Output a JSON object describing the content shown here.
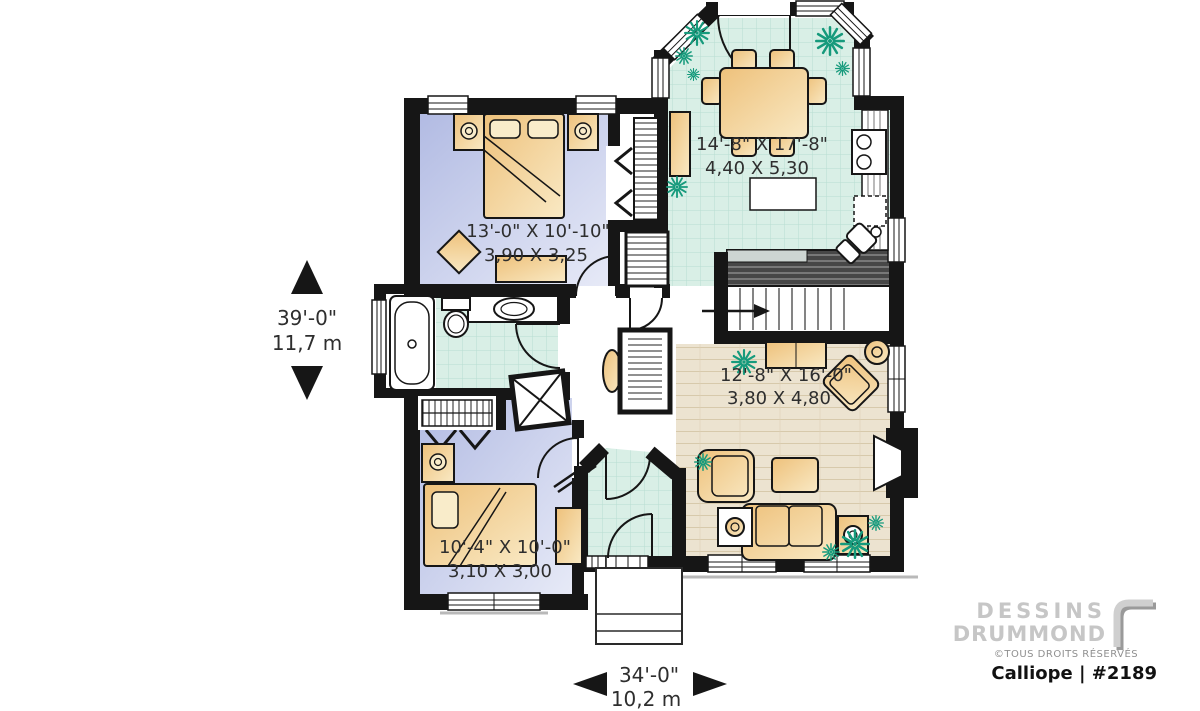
{
  "canvas": {
    "width": 1200,
    "height": 711,
    "background": "#ffffff"
  },
  "labels": {
    "dining": {
      "imperial": "14'-8\" X 17'-8\"",
      "metric": "4,40 X 5,30"
    },
    "master": {
      "imperial": "13'-0\" X 10'-10\"",
      "metric": "3,90 X 3,25"
    },
    "living": {
      "imperial": "12'-8\" X 16'-0\"",
      "metric": "3,80 X 4,80"
    },
    "bedroom2": {
      "imperial": "10'-4\" X 10'-0\"",
      "metric": "3,10 X 3,00"
    }
  },
  "dimensions": {
    "height": {
      "imperial": "39'-0\"",
      "metric": "11,7 m"
    },
    "width": {
      "imperial": "34'-0\"",
      "metric": "10,2 m"
    }
  },
  "branding": {
    "name_line1": "DESSINS",
    "name_line2": "DRUMMOND",
    "rights": "©TOUS DROITS RÉSERVÉS",
    "plan_id": "Calliope | #2189"
  },
  "palette": {
    "wall": "#161616",
    "tile": "#d9efe6",
    "tile_line": "#b7ddd1",
    "bedroom_floor": "#b2bbe3",
    "wood_floor": "#ece3d0",
    "furniture": "#eec17b",
    "plant": "#169a7c"
  }
}
